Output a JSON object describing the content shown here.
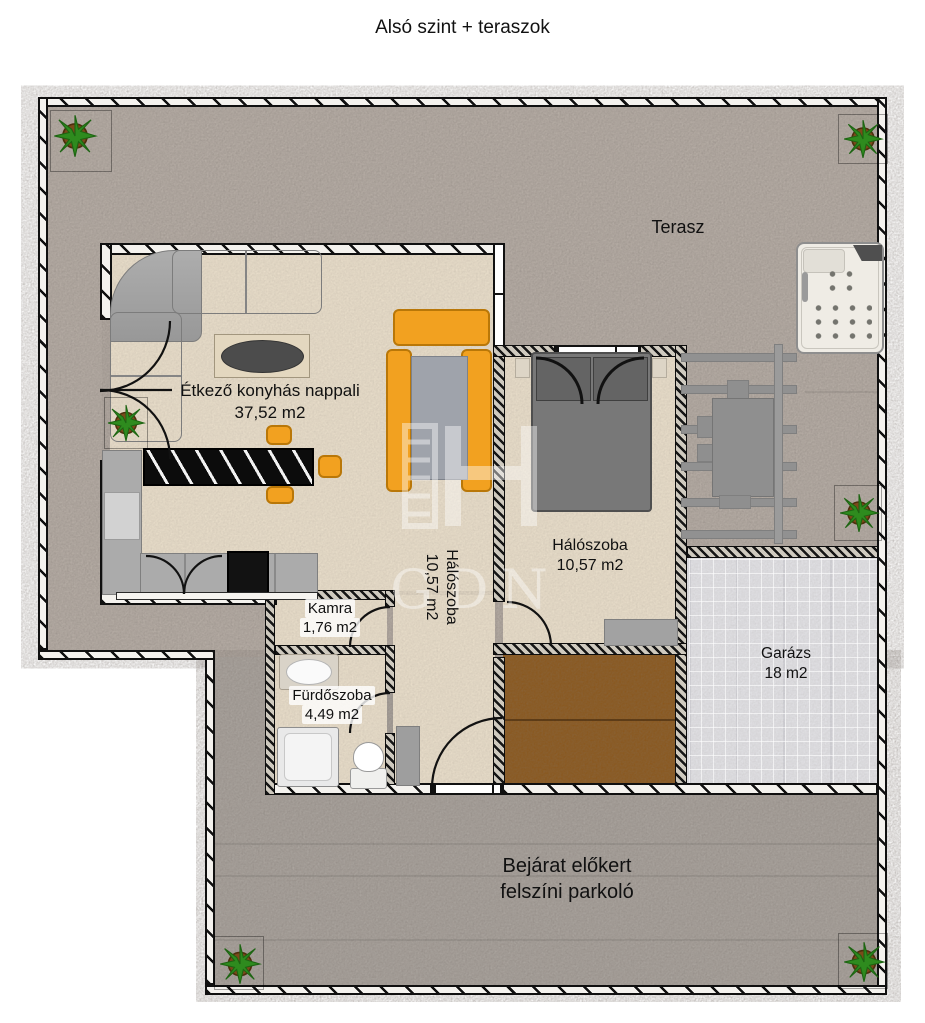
{
  "title": "Alsó szint + teraszok",
  "watermark": {
    "text": "GDN"
  },
  "rooms": {
    "terasz": {
      "label": "Terasz"
    },
    "living": {
      "label": "Étkező konyhás nappali",
      "area": "37,52 m2"
    },
    "bedroom_mid": {
      "label": "Hálószoba",
      "area": "10,57 m2"
    },
    "bedroom_right": {
      "label": "Hálószoba",
      "area": "10,57 m2"
    },
    "kamra": {
      "label": "Kamra",
      "area": "1,76 m2"
    },
    "bathroom": {
      "label": "Fürdőszoba",
      "area": "4,49 m2"
    },
    "garage": {
      "label": "Garázs",
      "area": "18 m2"
    },
    "parking": {
      "line1": "Bejárat előkert",
      "line2": "felszíni parkoló"
    }
  },
  "colors": {
    "accent_orange": "#F2A120",
    "deck_brown": "#8A571C",
    "indoor_floor": "#EADFCB",
    "outdoor_floor": "#B8AFA7",
    "parking_floor": "#ABA59F",
    "garage_floor": "#E2E2E6",
    "wall_black": "#111111"
  }
}
